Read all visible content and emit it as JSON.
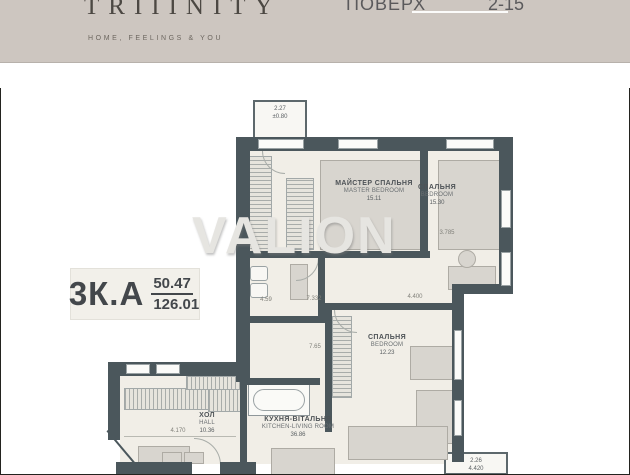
{
  "header": {
    "brand": "TRIIINITY",
    "tagline": "HOME, FEELINGS & YOU",
    "floor_label": "ПОВЕРХ",
    "floor_value": "2-15"
  },
  "watermark": "VALION",
  "unit_badge": {
    "type": "3К.А",
    "area_1": "50.47",
    "area_2": "126.01"
  },
  "rooms": {
    "master_bedroom": {
      "name": "МАЙСТЕР СПАЛЬНЯ",
      "name_en": "MASTER BEDROOM",
      "area": "15.11"
    },
    "bedroom_2": {
      "name": "СПАЛЬНЯ",
      "name_en": "BEDROOM",
      "area": "15.30"
    },
    "bedroom_3": {
      "name": "СПАЛЬНЯ",
      "name_en": "BEDROOM",
      "area": "12.23"
    },
    "hall": {
      "name": "ХОЛ",
      "name_en": "HALL",
      "area": "10.36"
    },
    "kitchen_living": {
      "name": "КУХНЯ-ВІТАЛЬНЯ",
      "name_en": "KITCHEN-LIVING ROOM",
      "area": "36.86"
    },
    "balcony_top": {
      "area": "2.27",
      "level": "±0.80"
    },
    "balcony_bottom": {
      "area": "2.26",
      "level": "4.420"
    }
  },
  "dimensions": {
    "hall_width": "4.170",
    "upper_width": "7.332",
    "bedroom2_depth": "3.785",
    "bathroom": "4.59",
    "corridor": "7.65",
    "bedroom3_width": "4.400"
  },
  "colors": {
    "header_bg": "#cdc6c0",
    "wall": "#4b575c",
    "room_fill": "#f1eee7",
    "furniture": "#d8d5cf",
    "brand_text": "#4c4843"
  }
}
